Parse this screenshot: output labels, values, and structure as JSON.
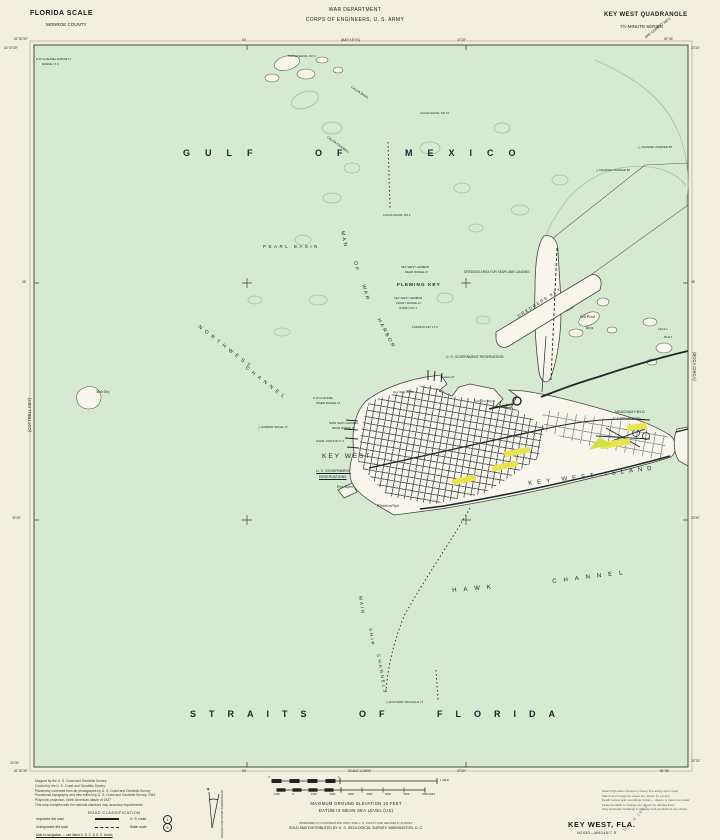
{
  "colors": {
    "paper": "#f2efe1",
    "water": "#d7e9d0",
    "land": "#f8f6ec",
    "accent_yellow": "#e9e34f",
    "accent_park": "#cfe14c",
    "stamp_purple": "#8f6aa8"
  },
  "header": {
    "region": "FLORIDA SCALE",
    "county": "MONROE COUNTY",
    "dept_line1": "WAR DEPARTMENT",
    "dept_line2": "CORPS OF ENGINEERS, U. S. ARMY",
    "quad_title": "KEY WEST QUADRANGLE",
    "quad_series": "7½-MINUTE SERIES"
  },
  "adjoining": {
    "top": "(BAY KEYS)",
    "left": "(COTTRELL KEY)",
    "right": "(BOCA CHICA)",
    "corner": "(BIG COPPITT KEY)"
  },
  "footer": {
    "title": "KEY WEST, FLA.",
    "designation": "N2430—W8145/7.5",
    "stamp": "MAY 6 1943"
  },
  "scale": {
    "caption": "SCALE 1:24000",
    "mile_left": "½",
    "mile_zero": "0",
    "mile_right": "1 MILE",
    "feet_ticks": [
      "1000",
      "0",
      "1000",
      "2000",
      "3000",
      "4000",
      "5000",
      "6000",
      "7000 FEET"
    ],
    "elevation_note": "MAXIMUM GROUND ELEVATION 10 FEET",
    "datum_note": "DATUM IS MEAN SEA LEVEL (US)",
    "prepared_note": "PREPARED IN COOPERATION WITH THE U. S. COAST AND GEODETIC SURVEY",
    "sold_note": "SOLD AND DISTRIBUTED BY U. S. GEOLOGICAL SURVEY, WASHINGTON, D. C."
  },
  "credits": [
    "Mapped by the U. S. Coast and Geodetic Survey",
    "Control by the U. S. Coast and Geodetic Survey",
    "Planimetry corrected from air photographs by U. S. Coast and Geodetic Survey",
    "Provisional topography and new edition by U. S. Coast and Geodetic Survey, 1943",
    "Polyconic projection. North American datum of 1927",
    "This map complies with the national standard map accuracy requirements"
  ],
  "road_class": {
    "title": "ROAD CLASSIFICATION",
    "row1_label": "Improved dirt road",
    "row1_right": "U. S. route",
    "row1_badge": "1",
    "row2_label": "Unimproved dirt road",
    "row2_right": "State route",
    "row2_badge": "5",
    "note": "Aids to navigation — see latest U. S. C. & G. S. charts"
  },
  "declination": {
    "caption": "APPROXIMATE MEAN DECLINATION, 1943"
  },
  "notes_right": [
    "Mean high water shown by heavy line along open coast",
    "Marsh and mangrove areas are shown by symbol",
    "Depth curves and soundings in feet — datum is mean low water",
    "Features liable to change are shown by dashed lines",
    "Only landmark buildings in densely built-up districts are shown"
  ],
  "labels": [
    {
      "name": "label-gulf-of-mexico",
      "text": "GULF OF MEXICO",
      "x": 183,
      "y": 149,
      "size": 9,
      "ls": 15,
      "ws": 30,
      "bold": true
    },
    {
      "name": "label-straits-of-florida",
      "text": "STRAITS OF FLORIDA",
      "x": 190,
      "y": 710,
      "size": 9,
      "ls": 13,
      "ws": 24,
      "bold": true
    },
    {
      "name": "label-pearl-basin",
      "text": "PEARL BASIN",
      "x": 263,
      "y": 245,
      "size": 4.5,
      "ls": 2.5
    },
    {
      "name": "label-northwest",
      "text": "NORTHWEST",
      "x": 200,
      "y": 325,
      "size": 5,
      "ls": 4,
      "rot": 38
    },
    {
      "name": "label-nw-channel",
      "text": "CHANNEL",
      "x": 247,
      "y": 366,
      "size": 5,
      "ls": 4,
      "rot": 38
    },
    {
      "name": "label-man",
      "text": "MAN",
      "x": 344,
      "y": 231,
      "size": 5,
      "ls": 2,
      "rot": 78
    },
    {
      "name": "label-of",
      "text": "OF",
      "x": 357,
      "y": 261,
      "size": 5,
      "ls": 2,
      "rot": 80
    },
    {
      "name": "label-war",
      "text": "WAR",
      "x": 365,
      "y": 284,
      "size": 5,
      "ls": 2,
      "rot": 74
    },
    {
      "name": "label-harbor",
      "text": "HARBOR",
      "x": 380,
      "y": 318,
      "size": 5,
      "ls": 2,
      "rot": 62
    },
    {
      "name": "label-hawk",
      "text": "HAWK",
      "x": 452,
      "y": 588,
      "size": 6,
      "ls": 7,
      "rot": -5
    },
    {
      "name": "label-hawk-channel",
      "text": "CHANNEL",
      "x": 552,
      "y": 579,
      "size": 6,
      "ls": 7,
      "rot": -7
    },
    {
      "name": "label-key-west-island",
      "text": "KEY WEST ISLAND",
      "x": 528,
      "y": 481,
      "size": 6,
      "ls": 5,
      "rot": -7
    },
    {
      "name": "label-main",
      "text": "MAIN",
      "x": 362,
      "y": 596,
      "size": 4.5,
      "ls": 2,
      "rot": 82
    },
    {
      "name": "label-ship",
      "text": "SHIP",
      "x": 372,
      "y": 628,
      "size": 4.5,
      "ls": 2,
      "rot": 82
    },
    {
      "name": "label-channels",
      "text": "CHANNELS",
      "x": 380,
      "y": 654,
      "size": 4.5,
      "ls": 2,
      "rot": 80
    },
    {
      "name": "label-fleming-key",
      "text": "FLEMING KEY",
      "x": 397,
      "y": 283,
      "size": 4.8,
      "ls": 1,
      "bold": true
    },
    {
      "name": "label-key-west",
      "text": "KEY WEST",
      "x": 322,
      "y": 454,
      "size": 6.5,
      "ls": 2
    },
    {
      "name": "label-us-govt-1",
      "text": "U. S. GOVERNMENT",
      "x": 316,
      "y": 470,
      "size": 3.6,
      "underline": true
    },
    {
      "name": "label-us-govt-2",
      "text": "RESERVATIONS",
      "x": 319,
      "y": 476,
      "size": 3.6,
      "underline": true
    },
    {
      "name": "label-fort-taylor",
      "text": "Fort Taylor",
      "x": 337,
      "y": 486,
      "size": 3.6,
      "italic": true
    },
    {
      "name": "label-whitehead-spit",
      "text": "Whitehead Spit",
      "x": 377,
      "y": 505,
      "size": 3.6,
      "italic": true
    },
    {
      "name": "label-trumbo-pt",
      "text": "Trumbo Pt",
      "x": 440,
      "y": 376,
      "size": 3.4,
      "italic": true
    },
    {
      "name": "label-key-west-bight",
      "text": "Key West Bight",
      "x": 393,
      "y": 391,
      "size": 3.4,
      "italic": true
    },
    {
      "name": "label-garrison-bight",
      "text": "Garrison Bight",
      "x": 474,
      "y": 400,
      "size": 3.4,
      "italic": true
    },
    {
      "name": "label-dredgers-key",
      "text": "DREDGERS KEY",
      "x": 517,
      "y": 315,
      "size": 4.2,
      "ls": 1.5,
      "rot": -33
    },
    {
      "name": "label-salt-pond",
      "text": "Salt Pond",
      "x": 580,
      "y": 315,
      "size": 3.8,
      "italic": true
    },
    {
      "name": "label-salt-pond-keys",
      "text": "Keys",
      "x": 586,
      "y": 326,
      "size": 3.8,
      "italic": true
    },
    {
      "name": "label-mule-key",
      "text": "Mule Key",
      "x": 96,
      "y": 391,
      "size": 3.6,
      "italic": true
    },
    {
      "name": "label-stock-island",
      "text": "Stock I.",
      "x": 658,
      "y": 328,
      "size": 3.4,
      "italic": true
    },
    {
      "name": "label-bird-island",
      "text": "Bird I.",
      "x": 664,
      "y": 336,
      "size": 3.4,
      "italic": true
    },
    {
      "name": "label-meacham-field",
      "text": "MEACHAM FIELD",
      "x": 615,
      "y": 411,
      "size": 3.6
    },
    {
      "name": "label-naval-air-station",
      "text": "U. S. Naval Air Station",
      "x": 613,
      "y": 417,
      "size": 3,
      "italic": true
    },
    {
      "name": "label-govt-reservation",
      "text": "U. S. GOVERNMENT RESERVATION",
      "x": 446,
      "y": 356,
      "size": 3.4
    },
    {
      "name": "label-seaplane-area",
      "text": "DREDGED AREA FOR SEAPLANE LANDING",
      "x": 464,
      "y": 271,
      "size": 3.2
    },
    {
      "name": "label-rear-range-1",
      "text": "KEY WEST HARBOR",
      "x": 401,
      "y": 266,
      "size": 2.9
    },
    {
      "name": "label-rear-range-2",
      "text": "REAR RANGE LT",
      "x": 405,
      "y": 271,
      "size": 2.9
    },
    {
      "name": "label-front-range-1",
      "text": "KEY WEST HARBOR",
      "x": 394,
      "y": 297,
      "size": 2.9
    },
    {
      "name": "label-front-range-2",
      "text": "FRONT RANGE LT",
      "x": 396,
      "y": 302,
      "size": 2.9
    },
    {
      "name": "label-front-range-3",
      "text": "(FIXED) NO 1",
      "x": 399,
      "y": 307,
      "size": 2.9
    },
    {
      "name": "label-fleming-lt",
      "text": "FLEMING KEY LT 2",
      "x": 412,
      "y": 326,
      "size": 2.9
    },
    {
      "name": "label-calda-channel",
      "text": "CALDA CHANNEL",
      "x": 328,
      "y": 136,
      "size": 3.2,
      "rot": 36
    },
    {
      "name": "label-calda-bank",
      "text": "CALDA BANK",
      "x": 352,
      "y": 86,
      "size": 3.2,
      "rot": 34
    },
    {
      "name": "label-calda-shoal-4",
      "text": "CALDA SHOAL NO 4",
      "x": 288,
      "y": 55,
      "size": 2.9
    },
    {
      "name": "label-calda-shoal-10",
      "text": "CALDA SHOAL NO 10",
      "x": 420,
      "y": 112,
      "size": 2.9
    },
    {
      "name": "label-calda-shoal-1",
      "text": "CALDA SHOAL NO 1",
      "x": 383,
      "y": 214,
      "size": 2.9
    },
    {
      "name": "label-channel-marker-85",
      "text": "△ CHANNEL MARKER 85",
      "x": 638,
      "y": 146,
      "size": 2.9
    },
    {
      "name": "label-channel-marker-80",
      "text": "△ CHANNEL MARKER 80",
      "x": 596,
      "y": 169,
      "size": 2.9
    },
    {
      "name": "label-nw-elbow-lt",
      "text": "N W CHANNEL ELBOW LT",
      "x": 36,
      "y": 58,
      "size": 2.9
    },
    {
      "name": "label-nw-elbow-lt2",
      "text": "RANGE LT 2",
      "x": 42,
      "y": 63,
      "size": 2.9
    },
    {
      "name": "label-inner-range-1",
      "text": "N W CHANNEL",
      "x": 313,
      "y": 397,
      "size": 2.9
    },
    {
      "name": "label-inner-range-2",
      "text": "INNER RANGE LT",
      "x": 316,
      "y": 402,
      "size": 2.9
    },
    {
      "name": "label-msc-range-1",
      "text": "MAIN SHIP CHANNEL",
      "x": 329,
      "y": 422,
      "size": 2.9
    },
    {
      "name": "label-msc-range-2",
      "text": "REAR RANGE LT",
      "x": 332,
      "y": 427,
      "size": 2.9
    },
    {
      "name": "label-naval-station-lt",
      "text": "NAVAL STATION LT 2",
      "x": 316,
      "y": 440,
      "size": 2.9
    },
    {
      "name": "label-harbor-shoal-lt",
      "text": "△ HARBOR SHOAL LT",
      "x": 258,
      "y": 426,
      "size": 2.9
    },
    {
      "name": "label-eastern-triangle-lt",
      "text": "△ EASTERN TRIANGLE LT",
      "x": 386,
      "y": 701,
      "size": 3
    },
    {
      "name": "edge-coordinate",
      "text": "81°52′30″",
      "x": 14,
      "y": 38,
      "size": 3.2,
      "color": "#333"
    },
    {
      "name": "edge-coordinate",
      "text": "24°37′30″",
      "x": 4,
      "y": 47,
      "size": 3.2,
      "color": "#333"
    },
    {
      "name": "edge-coordinate",
      "text": "50′",
      "x": 242,
      "y": 39,
      "size": 3.2,
      "color": "#333"
    },
    {
      "name": "edge-coordinate",
      "text": "47′30″",
      "x": 457,
      "y": 39,
      "size": 3.2,
      "color": "#333"
    },
    {
      "name": "edge-coordinate",
      "text": "81°45′",
      "x": 664,
      "y": 38,
      "size": 3.2,
      "color": "#333"
    },
    {
      "name": "edge-coordinate",
      "text": "37′30″",
      "x": 691,
      "y": 47,
      "size": 3.2,
      "color": "#333"
    },
    {
      "name": "edge-coordinate",
      "text": "35′",
      "x": 22,
      "y": 281,
      "size": 3.2,
      "color": "#333"
    },
    {
      "name": "edge-coordinate",
      "text": "32′30″",
      "x": 12,
      "y": 517,
      "size": 3.2,
      "color": "#333"
    },
    {
      "name": "edge-coordinate",
      "text": "35′",
      "x": 691,
      "y": 281,
      "size": 3.2,
      "color": "#333"
    },
    {
      "name": "edge-coordinate",
      "text": "32′30″",
      "x": 691,
      "y": 517,
      "size": 3.2,
      "color": "#333"
    },
    {
      "name": "edge-coordinate",
      "text": "24°30′",
      "x": 10,
      "y": 762,
      "size": 3.2,
      "color": "#333"
    },
    {
      "name": "edge-coordinate",
      "text": "81°52′30″",
      "x": 14,
      "y": 770,
      "size": 3.2,
      "color": "#333"
    },
    {
      "name": "edge-coordinate",
      "text": "50′",
      "x": 242,
      "y": 770,
      "size": 3.2,
      "color": "#333"
    },
    {
      "name": "edge-coordinate",
      "text": "47′30″",
      "x": 457,
      "y": 770,
      "size": 3.2,
      "color": "#333"
    },
    {
      "name": "edge-coordinate",
      "text": "81°45′",
      "x": 660,
      "y": 770,
      "size": 3.2,
      "color": "#333"
    },
    {
      "name": "edge-coordinate",
      "text": "24°30′",
      "x": 691,
      "y": 760,
      "size": 3.2,
      "color": "#333"
    },
    {
      "name": "label-scale-caption",
      "text": "SCALE 1:24000",
      "x": 348,
      "y": 770,
      "size": 3.2,
      "color": "#333"
    }
  ],
  "crosses": [
    [
      247,
      283
    ],
    [
      466,
      283
    ],
    [
      247,
      520
    ],
    [
      466,
      520
    ]
  ]
}
